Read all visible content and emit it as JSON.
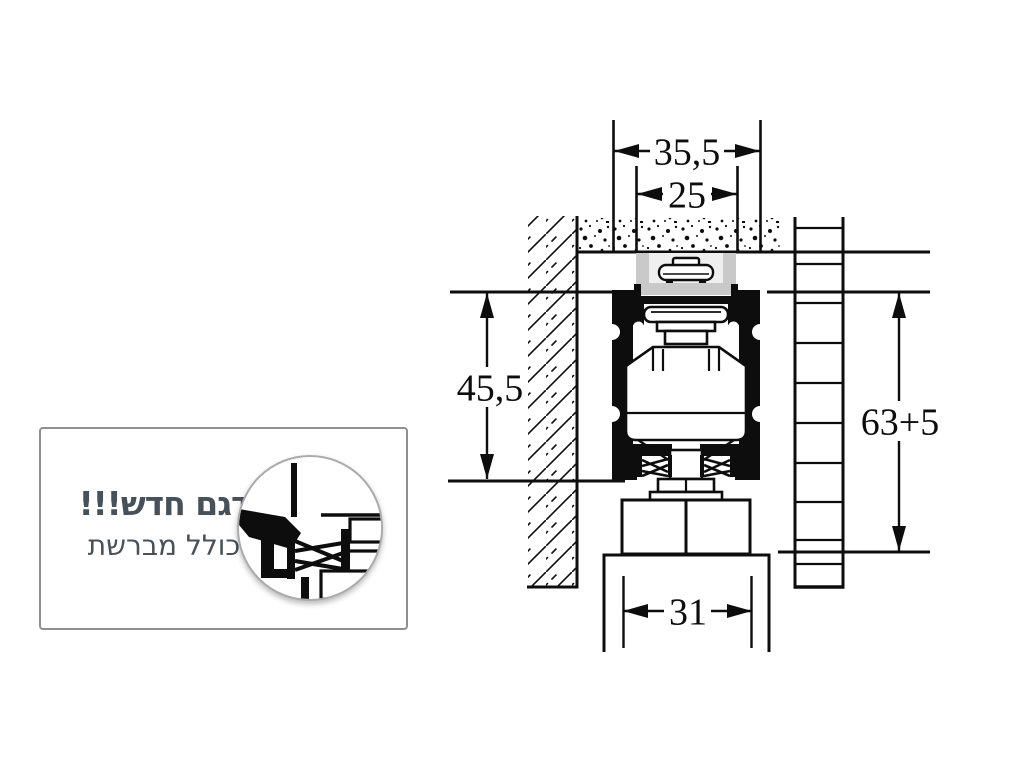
{
  "callout": {
    "line1": "דגם חדש!!!",
    "line2": "כולל מברשת",
    "text_color": "#47515a"
  },
  "diagram": {
    "dims": {
      "track_outer_width": "35,5",
      "ceiling_slot_width": "25",
      "track_height": "45,5",
      "overall_height": "63+5",
      "door_clamp_width": "31"
    },
    "colors": {
      "ink": "#0d0d0d",
      "bracket_gray": "#c9c9c9",
      "bracket_inner_gray": "#efefef"
    }
  }
}
